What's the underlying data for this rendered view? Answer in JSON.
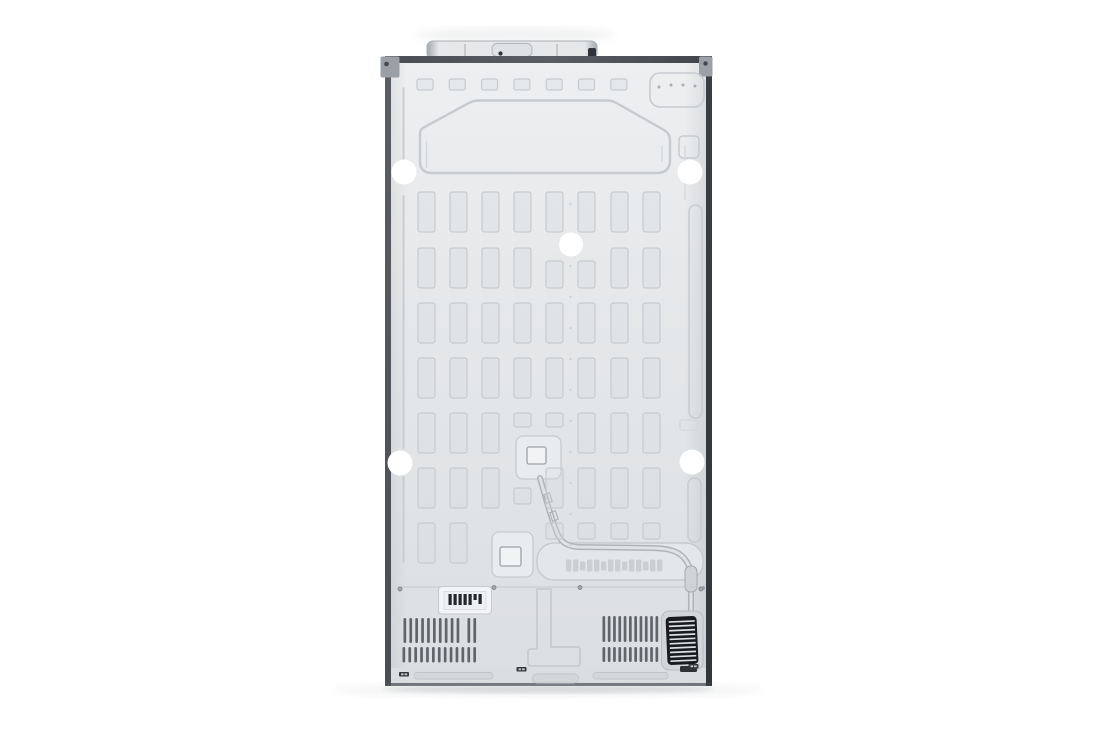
{
  "scene": {
    "subject": "refrigerator-back-panel",
    "view": "rear view of side-by-side refrigerator on white seamless background",
    "visible_text": ""
  },
  "palette": {
    "bg": "#ffffff",
    "panel_top": "#edeff1",
    "panel_mid": "#e6e8ea",
    "panel_low": "#e1e4e6",
    "panel_bottom": "#dcdfe2",
    "emboss": "#c7cbcf",
    "emboss_soft": "#d4d8db",
    "frame_top": "#4a4e54",
    "edge_left": "#5b5f65",
    "edge_right": "#3b3f45",
    "bracket": "#9ba0a6",
    "screw": "#43474d",
    "cover_light": "#e6e8ea",
    "cover_edge": "#a4a8ad",
    "cover_dark": "#30343a",
    "plug_white": "#ffffff",
    "slot_dark": "#60656c",
    "grille_bg": "#191b1f",
    "grille_line": "#dde0e3",
    "label_bg": "#f3f4f6",
    "barcode": "#24272b",
    "kick": "#dbdee1",
    "kick_groove": "#c2c6ca",
    "bottom_line": "#6e7277",
    "plate": "#e9ecee",
    "band": "#e4e7ea",
    "pipe_base": "#b0b4b9",
    "pipe_light": "#e0e3e6",
    "recess": "#d2d5d9"
  },
  "features": {
    "top_rects": {
      "x0": 417,
      "y": 79,
      "count": 7,
      "pitch": 32.3,
      "w": 16,
      "h": 11
    },
    "grid": {
      "cols": [
        418,
        450,
        482,
        514,
        546,
        578,
        611,
        643
      ],
      "col_w": 17,
      "rows": [
        {
          "y": 192,
          "h": 40
        },
        {
          "y": 248,
          "h": 40
        },
        {
          "y": 303,
          "h": 40
        },
        {
          "y": 358,
          "h": 40
        },
        {
          "y": 413,
          "h": 40
        },
        {
          "y": 468,
          "h": 40
        },
        {
          "y": 523,
          "h": 40
        }
      ],
      "mods": {
        "1,4": {
          "y": 261,
          "h": 27
        },
        "1,5": {
          "y": 261,
          "h": 27
        },
        "4,3": {
          "h": 14
        },
        "4,4": {
          "h": 14
        },
        "5,3": {
          "y": 488,
          "h": 16
        },
        "6,2": "skip",
        "6,3": "skip",
        "6,4": {
          "h": 16
        },
        "6,5": {
          "h": 16
        },
        "6,6": {
          "h": 16
        },
        "6,7": {
          "h": 16
        }
      }
    },
    "weld_dots": {
      "x": 570.5,
      "y0": 204,
      "count": 12,
      "step": 31,
      "r": 1.1
    },
    "white_plugs": [
      [
        404,
        172,
        12.5
      ],
      [
        690,
        172,
        12.5
      ],
      [
        571,
        244.5,
        12
      ],
      [
        400,
        463,
        12.5
      ],
      [
        692,
        462,
        12.5
      ]
    ],
    "stamp_marks": {
      "x0": 566,
      "y": 559.5,
      "count": 14,
      "pitch": 7.0,
      "w": 5.4,
      "h": 12
    },
    "barcode": {
      "x0": 448.5,
      "y": 594,
      "pitch": 5.0,
      "w": 3.2,
      "heights": [
        11,
        11,
        11,
        11,
        11,
        6,
        10
      ]
    },
    "vents": [
      {
        "name": "left-top-a",
        "x0": 403.5,
        "y": 618,
        "count": 10,
        "pitch": 5.9,
        "w": 2.7,
        "h": 25
      },
      {
        "name": "left-top-b",
        "x0": 467.5,
        "y": 618,
        "count": 2,
        "pitch": 5.9,
        "w": 2.7,
        "h": 25
      },
      {
        "name": "left-bottom",
        "x0": 402.5,
        "y": 647,
        "count": 13,
        "pitch": 5.9,
        "w": 2.7,
        "h": 15.5
      },
      {
        "name": "right-top",
        "x0": 602.5,
        "y": 616,
        "count": 11,
        "pitch": 5.3,
        "w": 2.7,
        "h": 26
      },
      {
        "name": "right-bottom",
        "x0": 602.5,
        "y": 647,
        "count": 11,
        "pitch": 5.3,
        "w": 2.7,
        "h": 15
      }
    ],
    "grille_lines": {
      "count": 10,
      "x1": 669.5,
      "x2": 695.5,
      "y0": 621.5,
      "step": 4.35
    },
    "bottom_marks": [
      [
        399,
        672
      ],
      [
        516.5,
        667
      ],
      [
        688.5,
        664
      ]
    ]
  }
}
